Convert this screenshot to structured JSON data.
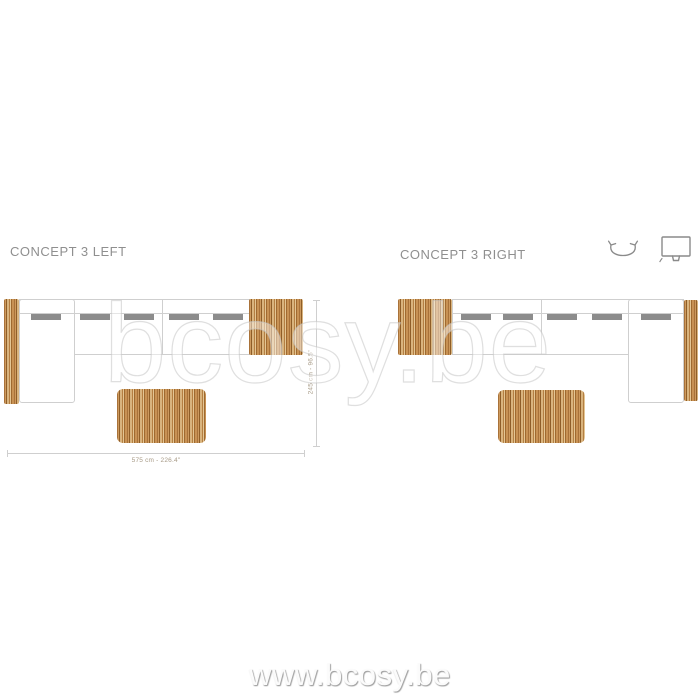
{
  "header": {
    "left_title": "CONCEPT 3 LEFT",
    "right_title": "CONCEPT 3 RIGHT",
    "icons": [
      {
        "name": "rotate-icon"
      },
      {
        "name": "monitor-icon"
      }
    ]
  },
  "diagrams": {
    "left": {
      "name": "concept-3-left-plan",
      "width_dimension": "575 cm - 226.4\"",
      "depth_dimension": "245 cm - 96.5\""
    },
    "right": {
      "name": "concept-3-right-plan"
    }
  },
  "watermark": {
    "center": "bcosy.be",
    "bottom": "www.bcosy.be"
  },
  "colors": {
    "title_gray": "#8f8f8f",
    "outline_gray": "#cfcfcf",
    "cushion_gray": "#8c8c8c",
    "dimension_text": "#a79a86",
    "wood_dark": "#8f5e28",
    "wood_mid": "#c08b4f",
    "wood_light": "#e4c694",
    "watermark_gray": "#e9e9e9"
  }
}
